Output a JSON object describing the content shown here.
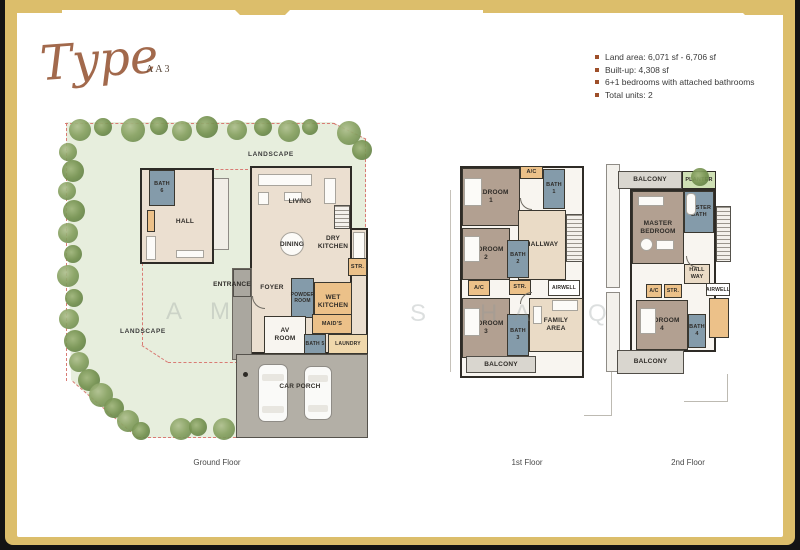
{
  "title": {
    "script": "Type",
    "variant": "AA3"
  },
  "legend": {
    "items": [
      "Land area: 6,071 sf - 6,706 sf",
      "Built-up: 4,308 sf",
      "6+1 bedrooms with attached bathrooms",
      "Total units: 2"
    ]
  },
  "watermark": {
    "letters": [
      "A",
      "M",
      "S",
      "H",
      "A",
      "Q"
    ]
  },
  "floors": {
    "ground": {
      "caption": "Ground Floor",
      "rooms": {
        "landscape_top": "LANDSCAPE",
        "landscape_left": "LANDSCAPE",
        "hall": "HALL",
        "bath6": "BATH\n6",
        "living": "LIVING",
        "dining": "DINING",
        "dry_kitchen": "DRY\nKITCHEN",
        "str": "STR.",
        "entrance": "ENTRANCE",
        "foyer": "FOYER",
        "powder_room": "POWDER\nROOM",
        "wet_kitchen": "WET\nKITCHEN",
        "av_room": "AV\nROOM",
        "maids": "MAID'S",
        "bath5": "BATH 5",
        "laundry": "LAUNDRY",
        "yard": "YARD",
        "car_porch": "CAR PORCH"
      }
    },
    "first": {
      "caption": "1st Floor",
      "rooms": {
        "bedroom1": "BEDROOM\n1",
        "ac_top": "A/C",
        "bath1": "BATH\n1",
        "hallway": "HALLWAY",
        "bedroom2": "BEDROOM\n2",
        "bath2": "BATH\n2",
        "ac_left": "A/C",
        "str": "STR.",
        "airwell": "AIRWELL",
        "bedroom3": "BEDROOM\n3",
        "bath3": "BATH\n3",
        "family_area": "FAMILY\nAREA",
        "balcony": "BALCONY"
      }
    },
    "second": {
      "caption": "2nd Floor",
      "rooms": {
        "balcony_top": "BALCONY",
        "planter": "PLANTER",
        "master_bedroom": "MASTER\nBEDROOM",
        "master_bath": "MASTER\nBATH",
        "hallway": "HALL\nWAY",
        "ac": "A/C",
        "str": "STR.",
        "airwell": "AIRWELL",
        "bedroom4": "BEDROOM\n4",
        "bath4": "BATH\n4",
        "balcony_bottom": "BALCONY"
      }
    }
  },
  "colors": {
    "frame_gold": "#dcbe6b",
    "bullet_rust": "#9e4f2a",
    "title_brown": "#a2694c",
    "landscape_green": "#e7eedd",
    "bedroom_mauve": "#b2a091",
    "bath_blue": "#849baa",
    "service_orange": "#ecc189",
    "porch_gray": "#b3afa6",
    "boundary_red": "#d97b74"
  }
}
